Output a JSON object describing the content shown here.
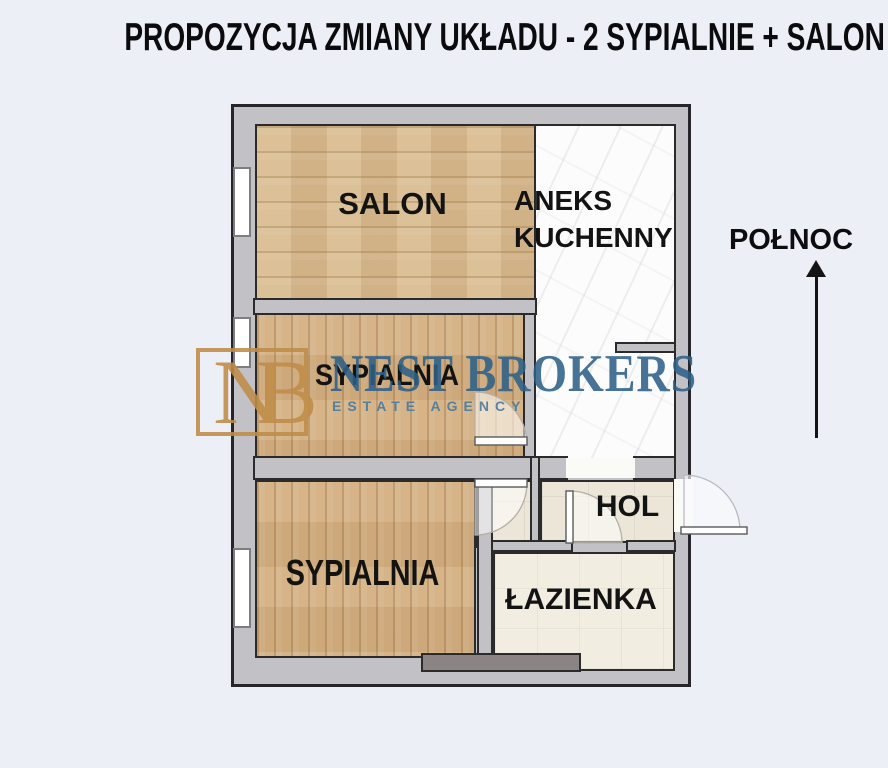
{
  "title": "PROPOZYCJA ZMIANY UKŁADU - 2 SYPIALNIE + SALON",
  "compass": {
    "label": "POŁNOC"
  },
  "rooms": {
    "salon": {
      "label": "SALON"
    },
    "kitchen": {
      "label": "ANEKS KUCHENNY"
    },
    "bedroom1": {
      "label": "SYPIALNIA"
    },
    "bedroom2": {
      "label": "SYPIALNIA"
    },
    "hall": {
      "label": "HOL"
    },
    "bathroom": {
      "label": "ŁAZIENKA"
    }
  },
  "watermark": {
    "monogram": "NB",
    "name": "NEST BROKERS",
    "tagline": "ESTATE AGENCY"
  },
  "colors": {
    "background": "#edeff7",
    "wall_fill": "#c2c2c6",
    "wall_outline": "#2b2b2b",
    "wood_salon": "#d8ba8e",
    "wood_bedroom": "#d2ae7f",
    "marble_kitchen": "#fcfcfc",
    "tile_hall": "#ebe6d8",
    "tile_bathroom": "#f1ede1",
    "logo_gold": "#c08c48",
    "logo_blue": "#2d6189",
    "fixture_gray": "#8a8582",
    "title_text": "#0b0b0d"
  }
}
